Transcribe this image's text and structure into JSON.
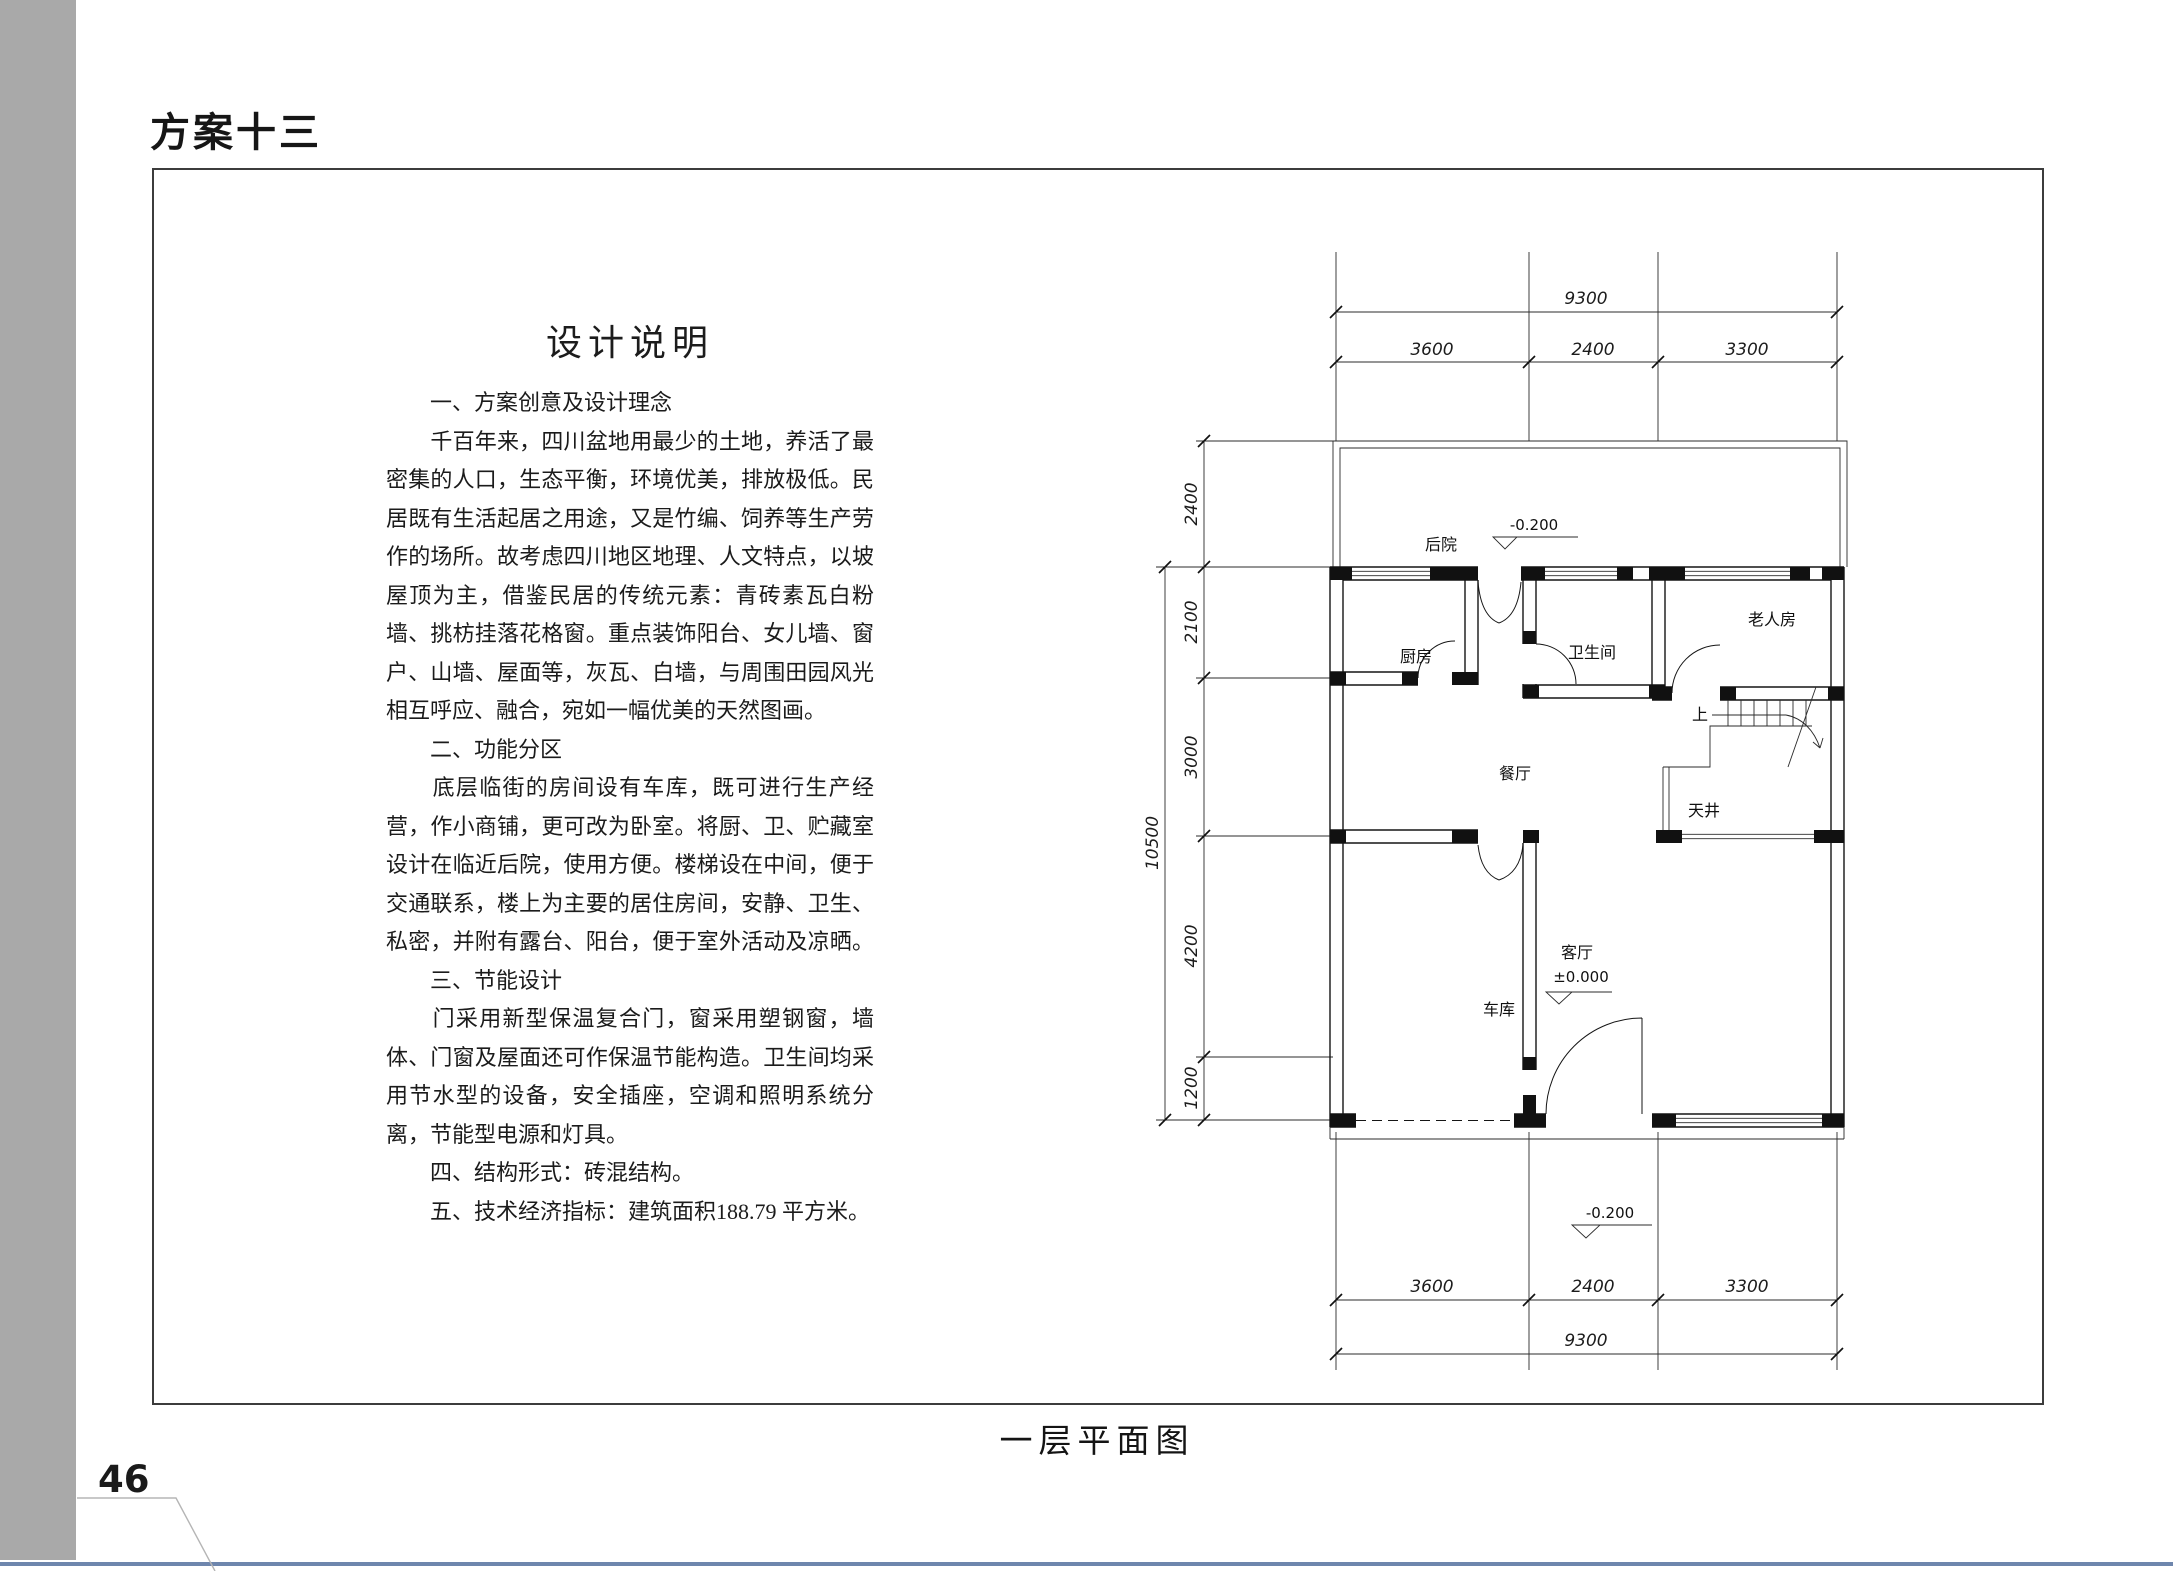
{
  "page": {
    "header": "方案十三",
    "page_number": "46",
    "caption": "一层平面图"
  },
  "description": {
    "title": "设计说明",
    "lines": [
      {
        "text": "　　一、方案创意及设计理念",
        "fill": false
      },
      {
        "text": "　　千百年来，四川盆地用最少的土地，养活了最",
        "fill": true
      },
      {
        "text": "密集的人口，生态平衡，环境优美，排放极低。民",
        "fill": true
      },
      {
        "text": "居既有生活起居之用途，又是竹编、饲养等生产劳",
        "fill": true
      },
      {
        "text": "作的场所。故考虑四川地区地理、人文特点，以坡",
        "fill": true
      },
      {
        "text": "屋顶为主，借鉴民居的传统元素：青砖素瓦白粉",
        "fill": true
      },
      {
        "text": "墙、挑枋挂落花格窗。重点装饰阳台、女儿墙、窗",
        "fill": true
      },
      {
        "text": "户、山墙、屋面等，灰瓦、白墙，与周围田园风光",
        "fill": true
      },
      {
        "text": "相互呼应、融合，宛如一幅优美的天然图画。",
        "fill": false
      },
      {
        "text": "　　二、功能分区",
        "fill": false
      },
      {
        "text": "　　底层临街的房间设有车库，既可进行生产经",
        "fill": true
      },
      {
        "text": "营，作小商铺，更可改为卧室。将厨、卫、贮藏室",
        "fill": true
      },
      {
        "text": "设计在临近后院，使用方便。楼梯设在中间，便于",
        "fill": true
      },
      {
        "text": "交通联系，楼上为主要的居住房间，安静、卫生、",
        "fill": true
      },
      {
        "text": "私密，并附有露台、阳台，便于室外活动及凉晒。",
        "fill": true
      },
      {
        "text": "　　三、节能设计",
        "fill": false
      },
      {
        "text": "　　门采用新型保温复合门，窗采用塑钢窗，墙",
        "fill": true
      },
      {
        "text": "体、门窗及屋面还可作保温节能构造。卫生间均采",
        "fill": true
      },
      {
        "text": "用节水型的设备，安全插座，空调和照明系统分",
        "fill": true
      },
      {
        "text": "离，节能型电源和灯具。",
        "fill": false
      },
      {
        "text": "　　四、结构形式：砖混结构。",
        "fill": false
      },
      {
        "text": "　　五、技术经济指标：建筑面积188.79 平方米。",
        "fill": false
      }
    ]
  },
  "floor_plan": {
    "dims_top": {
      "overall": "9300",
      "segments": [
        "3600",
        "2400",
        "3300"
      ]
    },
    "dims_bottom": {
      "overall": "9300",
      "segments": [
        "3600",
        "2400",
        "3300"
      ]
    },
    "dims_left": {
      "overall": "10500",
      "segments": [
        "2400",
        "2100",
        "3000",
        "4200",
        "1200"
      ]
    },
    "rooms": {
      "backyard": "后院",
      "kitchen": "厨房",
      "bathroom": "卫生间",
      "elder_room": "老人房",
      "dining": "餐厅",
      "courtyard": "天井",
      "living": "客厅",
      "garage": "车库",
      "stairs_up": "上"
    },
    "levels": {
      "backyard": "-0.200",
      "living": "±0.000",
      "entrance": "-0.200"
    }
  }
}
